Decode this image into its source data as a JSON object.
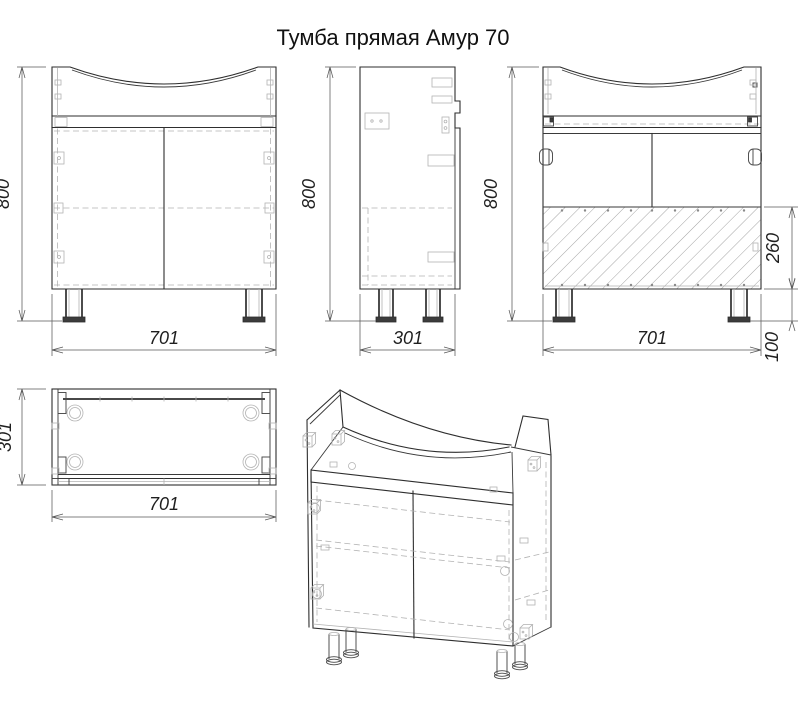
{
  "title": "Тумба прямая Амур 70",
  "views": {
    "front": {
      "label_height": "800",
      "label_width": "701"
    },
    "side": {
      "label_height": "800",
      "label_depth": "301"
    },
    "back": {
      "label_height": "800",
      "label_width": "701",
      "label_back_panel": "260",
      "label_leg": "100"
    },
    "top": {
      "label_depth": "301",
      "label_width": "701"
    }
  },
  "colors": {
    "background": "#ffffff",
    "outline": "#2e2e2e",
    "dimension": "#5a5a5a",
    "hidden_detail": "#b3b3b3",
    "hatch": "#9a9a9a",
    "text": "#1f1f1f"
  }
}
